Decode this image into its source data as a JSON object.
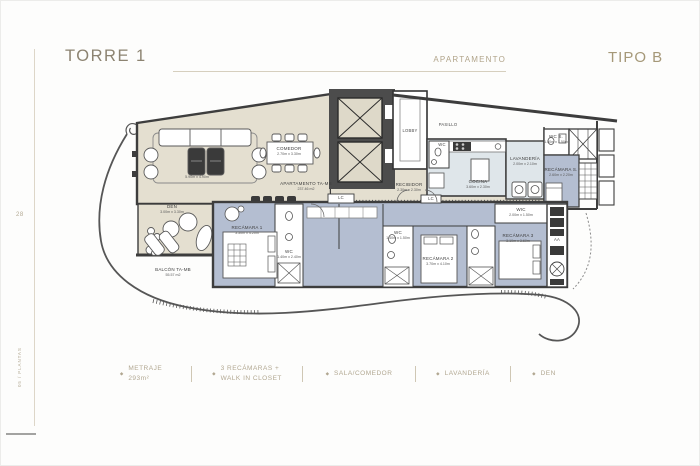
{
  "header": {
    "tower": "TORRE 1",
    "apartment_label": "APARTAMENTO",
    "type": "TIPO B"
  },
  "sidebar": {
    "page_number": "28",
    "section": "05 / PLANTAS"
  },
  "plan": {
    "rooms": {
      "sala": {
        "label": "SALA",
        "dims": "5.90m x 4.90m"
      },
      "comedor": {
        "label": "COMEDOR",
        "dims": "2.70m x 3.30m"
      },
      "den": {
        "label": "DEN",
        "dims": "3.00m x 3.30m"
      },
      "balcon": {
        "label": "BALCÓN TA-MB",
        "area": "55.57 m2"
      },
      "apartamento": {
        "label": "APARTAMENTO TA-MB",
        "area": "237.46 m2"
      },
      "recibidor": {
        "label": "RECIBIDOR",
        "dims": "2.30m x 2.30m"
      },
      "lobby": {
        "label": "LOBBY"
      },
      "pasillo": {
        "label": "PASILLO"
      },
      "cocina": {
        "label": "COCINA",
        "dims": "3.60m x 2.30m"
      },
      "lavanderia": {
        "label": "LAVANDERÍA",
        "dims": "2.00m x 2.10m"
      },
      "wc_s": {
        "label": "WC S.",
        "dims": "1.50m x 1.50m"
      },
      "recamara_s": {
        "label": "RECÁMARA S.",
        "dims": "2.60m x 2.20m"
      },
      "recamara_1": {
        "label": "RECÁMARA 1",
        "dims": "3.50m x 4.20m"
      },
      "wc_1": {
        "label": "WC",
        "dims": "1.40m x 2.40m"
      },
      "wc_2": {
        "label": "WC",
        "dims": "1.40m x 1.50m"
      },
      "recamara_2": {
        "label": "RECÁMARA 2",
        "dims": "3.70m x 4.10m"
      },
      "recamara_3": {
        "label": "RECÁMARA 3",
        "dims": "3.10m x 3.60m"
      },
      "wic_3": {
        "label": "WIC",
        "dims": "2.00m x 1.50m"
      },
      "powder_wc": {
        "label": "WC"
      },
      "lc_1": {
        "label": "LC"
      },
      "lc_2": {
        "label": "LC"
      },
      "aa": {
        "label": "AA"
      }
    },
    "colors": {
      "social_beige": "#e4dfd0",
      "bedroom_blue": "#b4bed1",
      "service_blue": "#dfe6ea",
      "wall_gray": "#3d3d3d",
      "accent_tan": "#a59878"
    }
  },
  "specs": {
    "bullet": "◆",
    "items": [
      {
        "line1": "METRAJE",
        "line2": "293m²"
      },
      {
        "line1": "3 RECÁMARAS +",
        "line2": "WALK IN CLOSET"
      },
      {
        "line1": "SALA/COMEDOR"
      },
      {
        "line1": "LAVANDERÍA"
      },
      {
        "line1": "DEN"
      }
    ]
  }
}
